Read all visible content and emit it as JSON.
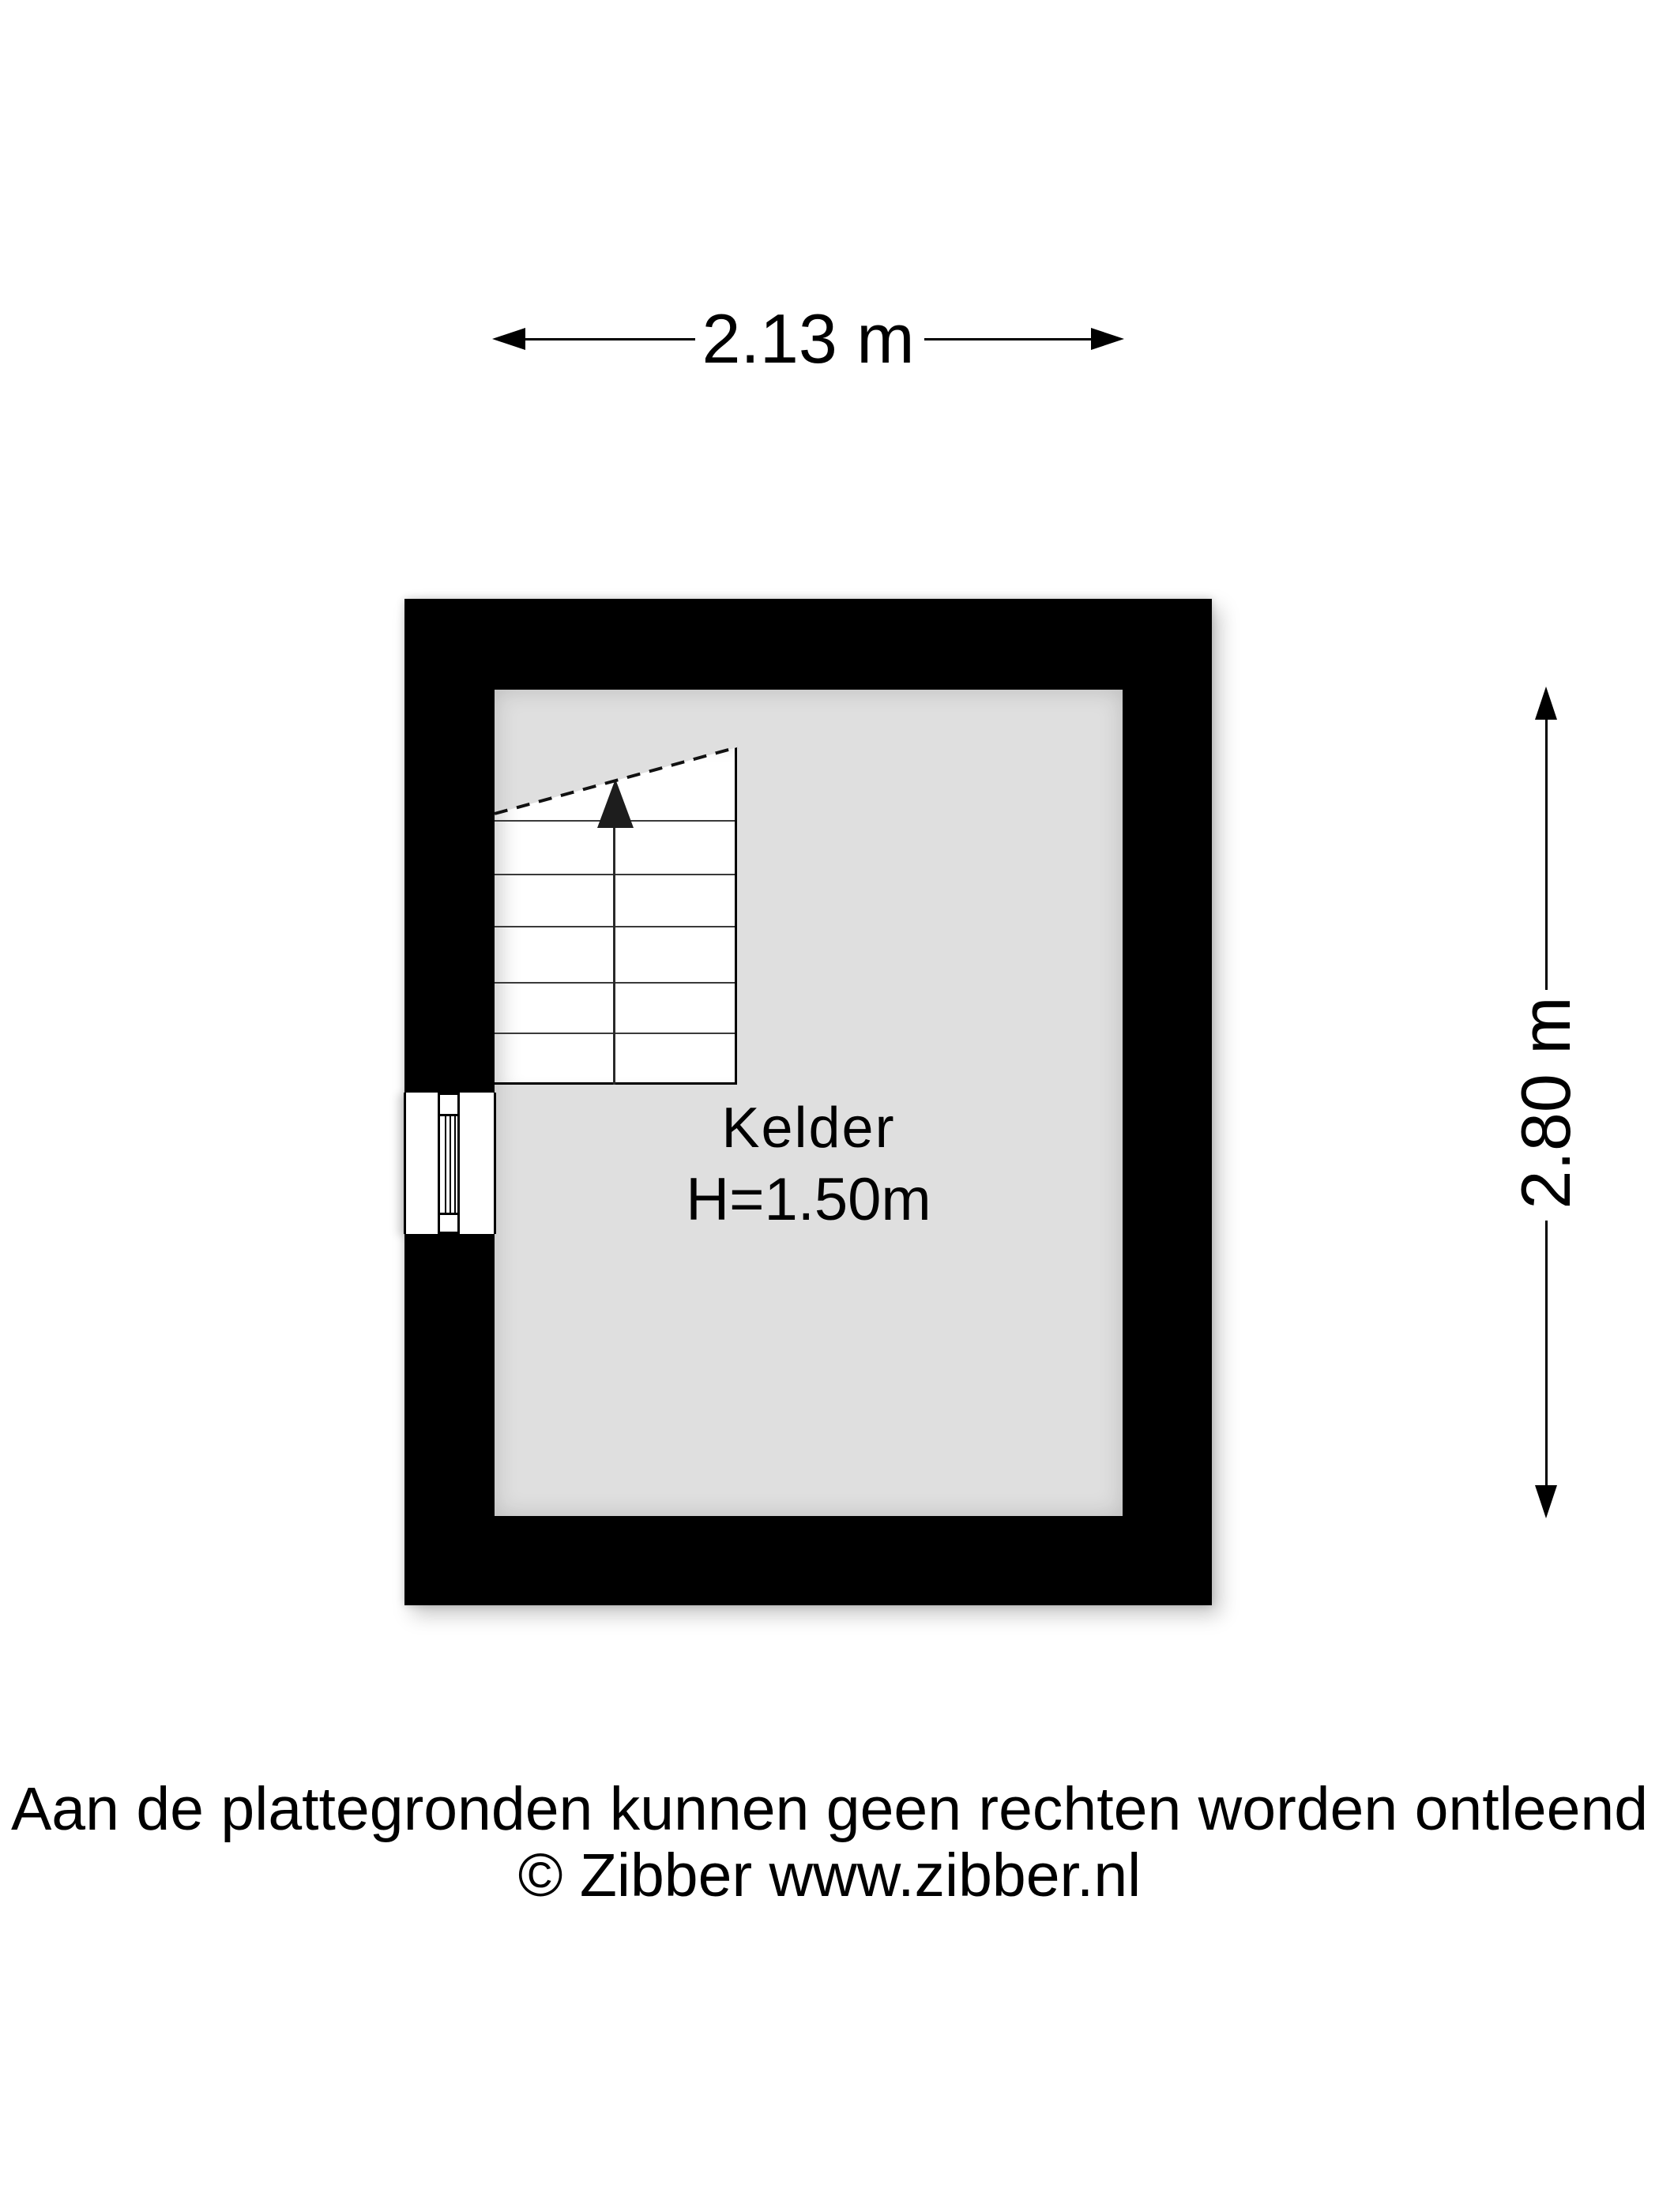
{
  "dimensions": {
    "width": {
      "label": "2.13 m"
    },
    "height": {
      "label": "2.80 m"
    }
  },
  "room": {
    "name": "Kelder",
    "ceiling_height": "H=1.50m"
  },
  "footer": {
    "disclaimer": "Aan de plattegronden kunnen geen rechten worden ontleend",
    "copyright": "© Zibber www.zibber.nl"
  },
  "colors": {
    "wall": "#000000",
    "floor": "#dfdfdf",
    "stairs": "#ffffff",
    "line": "#000000",
    "background": "#ffffff"
  }
}
